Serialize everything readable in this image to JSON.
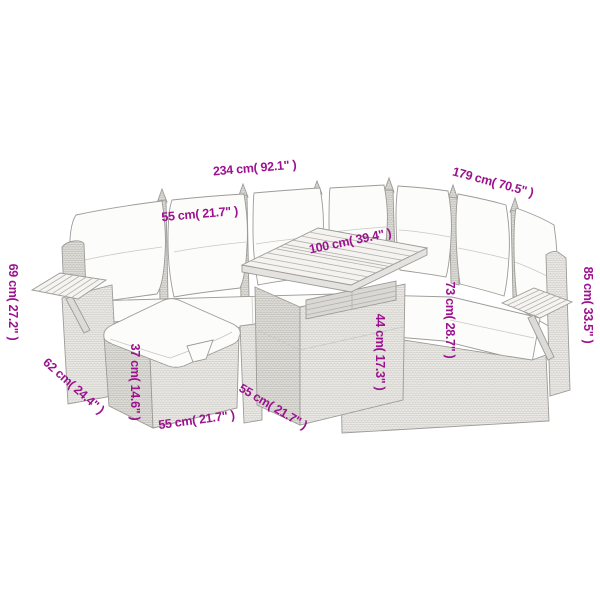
{
  "page": {
    "background": "#ffffff",
    "accent_color": "#9c128e",
    "line_art_color": "#9c9b97"
  },
  "diagram": {
    "type": "product-dimension-diagram",
    "subject": "rattan garden corner sofa set with footstool and slatted-top table",
    "dimensions": [
      {
        "id": "overall-width",
        "label": "234 cm( 92.1\" )",
        "x1": 64,
        "y1": 193,
        "x2": 388,
        "y2": 166,
        "lx": 255,
        "ly": 172,
        "la": -4.8
      },
      {
        "id": "overall-depth",
        "label": "179 cm( 70.5\" )",
        "x1": 388,
        "y1": 166,
        "x2": 562,
        "y2": 213,
        "lx": 492,
        "ly": 186,
        "la": 15.1
      },
      {
        "id": "backrest-width",
        "label": "55 cm( 21.7\" )",
        "x1": 158,
        "y1": 208,
        "x2": 241,
        "y2": 201,
        "lx": 200,
        "ly": 218,
        "la": -4.8
      },
      {
        "id": "table-length",
        "label": "100 cm( 39.4\" )",
        "x1": 272,
        "y1": 265,
        "x2": 427,
        "y2": 233,
        "lx": 351,
        "ly": 245,
        "la": -11.7
      },
      {
        "id": "armrest-height",
        "label": "69 cm( 27.2\" )",
        "x1": 28,
        "y1": 245,
        "x2": 28,
        "y2": 360,
        "lx": 9,
        "ly": 302,
        "la": 90
      },
      {
        "id": "overall-height",
        "label": "85 cm( 33.5\" )",
        "x1": 572,
        "y1": 226,
        "x2": 572,
        "y2": 383,
        "lx": 584,
        "ly": 305,
        "la": 90
      },
      {
        "id": "seat-back-height",
        "label": "73 cm( 28.7\" )",
        "x1": 435,
        "y1": 253,
        "x2": 435,
        "y2": 386,
        "lx": 446,
        "ly": 320,
        "la": 90
      },
      {
        "id": "table-height",
        "label": "44 cm( 17.3\" )",
        "x1": 365,
        "y1": 314,
        "x2": 365,
        "y2": 394,
        "lx": 376,
        "ly": 352,
        "la": 90
      },
      {
        "id": "ottoman-height",
        "label": "37 cm( 14.6\" )",
        "x1": 149,
        "y1": 345,
        "x2": 149,
        "y2": 418,
        "lx": 131,
        "ly": 382,
        "la": 90
      },
      {
        "id": "ottoman-width",
        "label": "55 cm( 21.7\" )",
        "x1": 151,
        "y1": 415,
        "x2": 241,
        "y2": 403,
        "lx": 197,
        "ly": 424,
        "la": -7.6
      },
      {
        "id": "ottoman-depth",
        "label": "62 cm( 24.4\" )",
        "x1": 63,
        "y1": 362,
        "x2": 98,
        "y2": 393,
        "lx": 71,
        "ly": 389,
        "la": 41.5
      },
      {
        "id": "table-depth",
        "label": "55 cm( 21.7\" )",
        "x1": 254,
        "y1": 383,
        "x2": 303,
        "y2": 412,
        "lx": 271,
        "ly": 410,
        "la": 30.6
      }
    ]
  }
}
